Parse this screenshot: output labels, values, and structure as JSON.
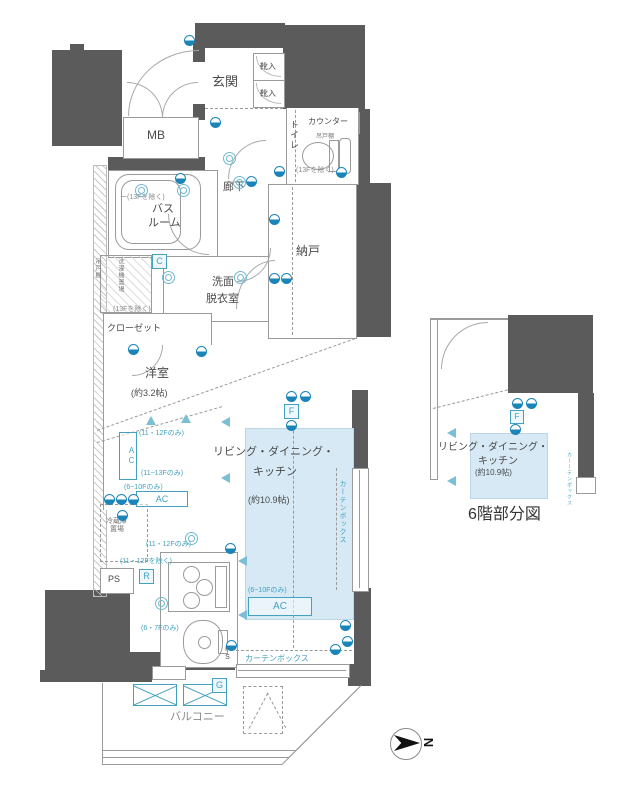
{
  "plan": {
    "rooms": {
      "genkan": "玄関",
      "shoe1": "靴入",
      "shoe2": "靴入",
      "mb": "MB",
      "counter": "カウンター",
      "toilet": "トイレ",
      "hallway": "廊下",
      "bath_l1": "バス",
      "bath_l2": "ルーム",
      "senmen_l1": "洗面",
      "senmen_l2": "脱衣室",
      "nando": "納戸",
      "closet": "クローゼット",
      "youshitsu": "洋室",
      "youshitsu_size": "(約3.2帖)",
      "ldk_l1": "リビング・ダイニング・",
      "ldk_l2": "キッチン",
      "ldk_size": "(約10.9帖)",
      "balcony": "バルコニー",
      "ps1": "PS",
      "ps2": "PS"
    },
    "fixtures": {
      "tsuridana_toilet": "吊戸棚",
      "tsuridana_wall": "吊戸棚",
      "washer": "洗濯機置場",
      "fridge_l1": "冷蔵庫",
      "fridge_l2": "置場",
      "curtain_box_h": "カーテンボックス",
      "curtain_box_v": "カーテンボックス",
      "ac": "AC"
    },
    "notes": {
      "except13f_bath": "ー(13Fを除く)",
      "except13f_toilet": "(13Fを除く)",
      "except13f_closet": "(13Fを除く)",
      "only11_12_a": "(11・12Fのみ)",
      "only11_13": "(11~13Fのみ)",
      "only6_10_a": "(6~10Fのみ)",
      "only11_12_b": "(11・12Fのみ)",
      "except11_12": "(11・12Fを除く)",
      "only6_7": "(6・7Fのみ)",
      "only6_10_b": "(6~10Fのみ)"
    },
    "symbols": {
      "c": "C",
      "f": "F",
      "r": "R",
      "g": "G",
      "t": "T"
    },
    "compass_north": "N"
  },
  "detail": {
    "title": "6階部分図",
    "ldk_l1": "リビング・ダイニング・",
    "ldk_l2": "キッチン",
    "ldk_size": "(約10.9帖)",
    "f": "F",
    "curtain_box": "カーーテンボックス"
  },
  "colors": {
    "wall": "#5b5b5b",
    "ldk_fill": "#d6e9f5",
    "accent": "#44a2c0"
  }
}
